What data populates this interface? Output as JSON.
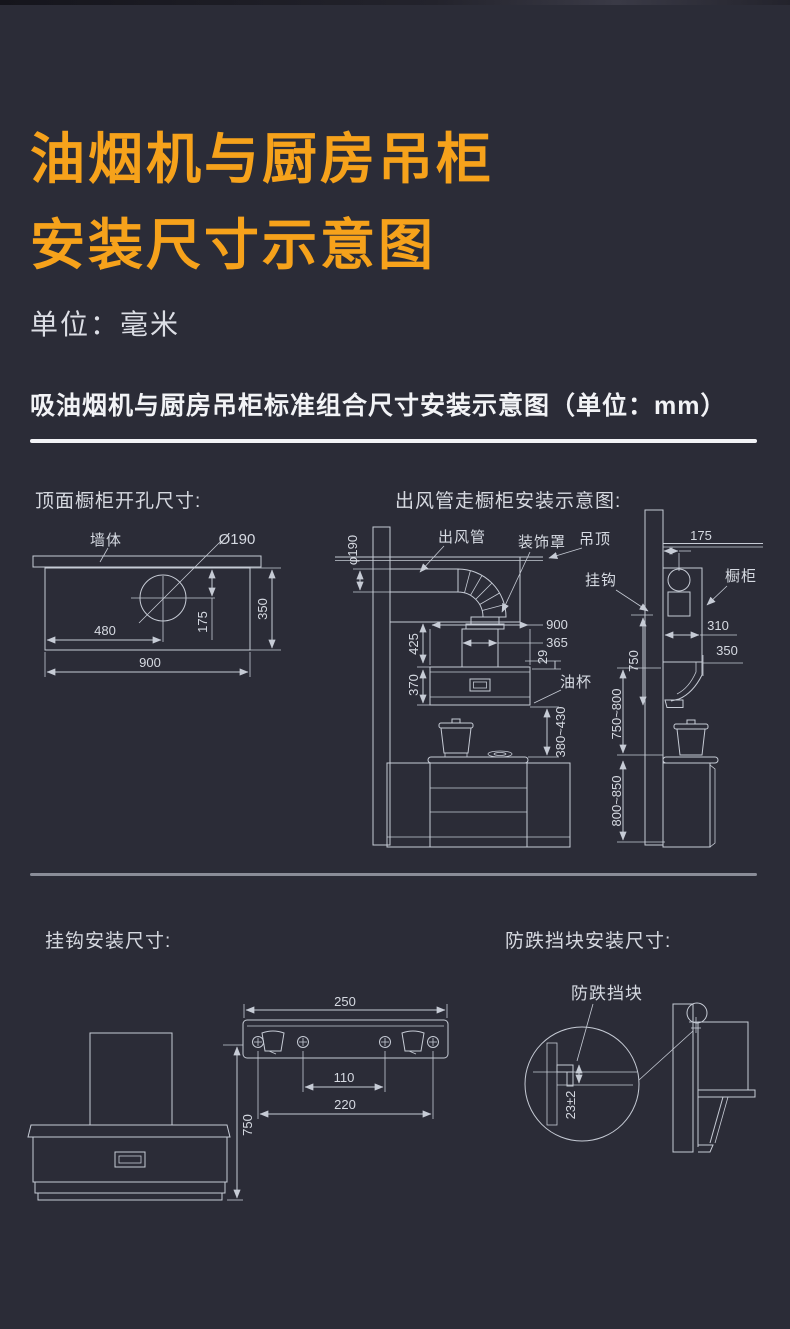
{
  "page": {
    "title_line1": "油烟机与厨房吊柜",
    "title_line2": "安装尺寸示意图",
    "unit_note": "单位：毫米",
    "section_heading": "吸油烟机与厨房吊柜标准组合尺寸安装示意图（单位：mm）"
  },
  "colors": {
    "background": "#2b2c37",
    "accent_orange": "#f6a21b",
    "heading_white": "#f2f3f6",
    "diagram_line": "#c6cbd5"
  },
  "top_opening": {
    "heading": "顶面橱柜开孔尺寸:",
    "wall_label": "墙体",
    "hole_label": "Ø190",
    "dim_480": "480",
    "dim_175": "175",
    "dim_350": "350",
    "dim_900": "900"
  },
  "duct_diagram": {
    "heading": "出风管走橱柜安装示意图:",
    "duct_label": "出风管",
    "cover_label": "装饰罩",
    "ceiling_label": "吊顶",
    "hook_label": "挂钩",
    "cabinet_label": "橱柜",
    "oil_cup_label": "油杯",
    "dim_phi190": "φ190",
    "dim_175": "175",
    "dim_900": "900",
    "dim_365": "365",
    "dim_29": "29",
    "dim_425": "425",
    "dim_370": "370",
    "dim_310": "310",
    "dim_350": "350",
    "dim_750": "750",
    "dim_380_430": "380~430",
    "dim_750_800": "750~800",
    "dim_800_850": "800~850"
  },
  "hook_diagram": {
    "heading": "挂钩安装尺寸:",
    "dim_250": "250",
    "dim_110": "110",
    "dim_220": "220",
    "dim_750": "750"
  },
  "block_diagram": {
    "heading": "防跌挡块安装尺寸:",
    "block_label": "防跌挡块",
    "dim_23": "23±2"
  }
}
